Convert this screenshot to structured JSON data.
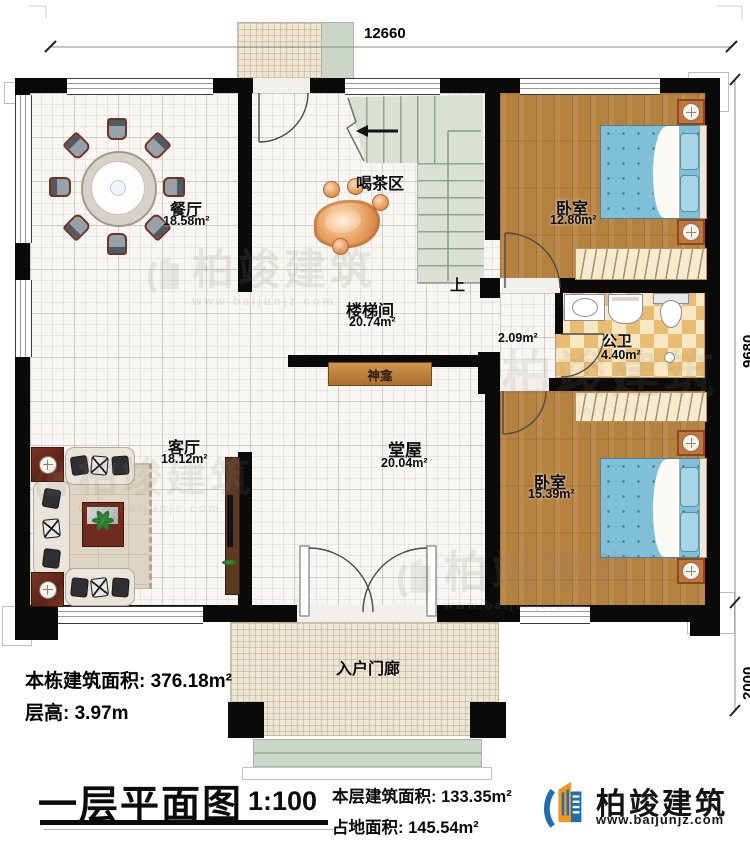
{
  "dims": {
    "top": "12660",
    "right": "9680",
    "porch": "2000"
  },
  "rooms": {
    "dining": {
      "name": "餐厅",
      "area": "18.58m²"
    },
    "tea": {
      "name": "喝茶区"
    },
    "stairwell": {
      "name": "楼梯间",
      "area": "20.74m²"
    },
    "bedroom_top": {
      "name": "卧室",
      "area": "12.80m²"
    },
    "bathroom": {
      "name": "公卫",
      "area": "4.40m²"
    },
    "hallway": {
      "area": "2.09m²"
    },
    "shrine": {
      "name": "神龛"
    },
    "living": {
      "name": "客厅",
      "area": "18.12m²"
    },
    "hall": {
      "name": "堂屋",
      "area": "20.04m²"
    },
    "bedroom_bottom": {
      "name": "卧室",
      "area": "15.39m²"
    },
    "porch": {
      "name": "入户门廊"
    },
    "stair_up": "上"
  },
  "info": {
    "building_area": {
      "label": "本栋建筑面积:",
      "value": "376.18m²"
    },
    "floor_height": {
      "label": "层高:",
      "value": "3.97m"
    }
  },
  "titleblock": {
    "title": "一层平面图",
    "scale": "1:100",
    "floor_area": {
      "label": "本层建筑面积:",
      "value": "133.35m²"
    },
    "land_area": {
      "label": "占地面积:",
      "value": "145.54m²"
    }
  },
  "brand": {
    "name": "柏竣建筑",
    "url": "www.baijunjz.com"
  },
  "watermark": {
    "name": "柏竣建筑",
    "url": "www.baijunjz.com"
  },
  "colors": {
    "brand_blue": "#1d6db5",
    "brand_orange": "#f2991d",
    "wall": "#0a0a0a",
    "wood_floor": "#b5813f",
    "bath_tile": "#e8bc72",
    "bed_blue": "#7fc0d8",
    "stair_sage": "#d9e0d4",
    "porch_beige": "#ece5d1"
  }
}
